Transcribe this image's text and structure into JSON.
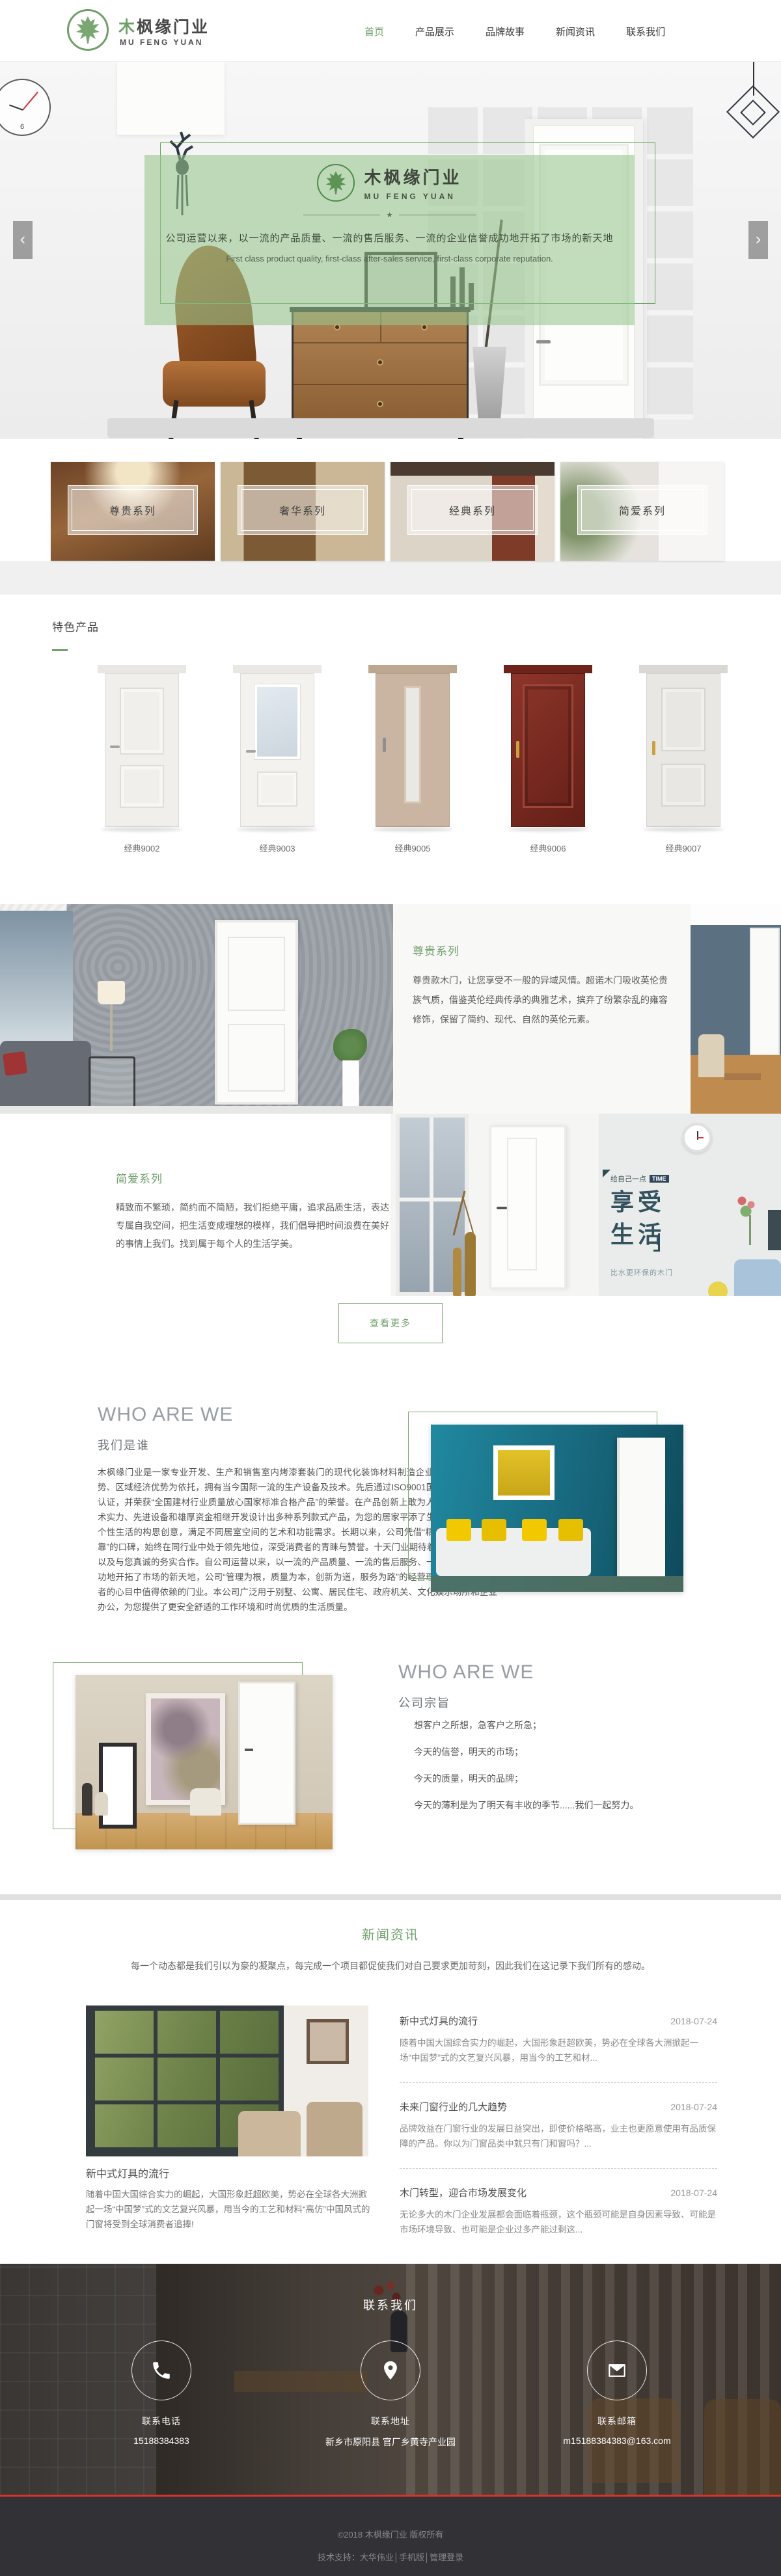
{
  "brand": {
    "name_first": "木",
    "name_rest": "枫缘门业",
    "name_en": "MU FENG YUAN"
  },
  "nav": {
    "items": [
      {
        "label": "首页",
        "active": true
      },
      {
        "label": "产品展示",
        "active": false
      },
      {
        "label": "品牌故事",
        "active": false
      },
      {
        "label": "新闻资讯",
        "active": false
      },
      {
        "label": "联系我们",
        "active": false
      }
    ]
  },
  "hero": {
    "logo_cn": "木枫缘门业",
    "logo_en": "MU FENG YUAN",
    "star": "★",
    "slogan_cn": "公司运营以来，以一流的产品质量、一流的售后服务、一流的企业信誉成功地开拓了市场的新天地",
    "slogan_en": "First class product quality, first-class after-sales service, first-class corporate reputation.",
    "prev": "‹",
    "next": "›"
  },
  "series_cards": [
    {
      "label": "尊贵系列"
    },
    {
      "label": "奢华系列"
    },
    {
      "label": "经典系列"
    },
    {
      "label": "简爱系列"
    }
  ],
  "featured": {
    "title": "特色产品",
    "products": [
      {
        "name": "经典9002"
      },
      {
        "name": "经典9003"
      },
      {
        "name": "经典9005"
      },
      {
        "name": "经典9006"
      },
      {
        "name": "经典9007"
      }
    ]
  },
  "zungui": {
    "title": "尊贵系列",
    "text": "尊贵款木门，让您享受不一般的异域风情。超诺木门吸收英伦贵族气质，借鉴英伦经典传承的典雅艺术，摈弃了纷繁杂乱的雍容修饰，保留了简约、现代、自然的英伦元素。"
  },
  "jianai": {
    "title": "简爱系列",
    "text": "精致而不繁琐，简约而不简陋，我们拒绝平庸，追求品质生活，表达专属自我空间，把生活变成理想的模样，我们倡导把时间浪费在美好的事情上我们。找到属于每个人的生活学美。",
    "promo_small": "给自己一点",
    "promo_tag": "TIME",
    "promo_big1": "享受",
    "promo_big2": "生活",
    "promo_sub": "比水更环保的木门"
  },
  "more_button": "查看更多",
  "about1": {
    "heading_en": "WHO ARE WE",
    "heading_cn": "我们是谁",
    "paragraph": "木枫缘门业是一家专业开发、生产和销售室内烤漆套装门的现代化装饰材料制造企业，公司以地域优势、区域经济优势为依托，拥有当今国际一流的生产设备及技术。先后通过ISO9001国际质量管理体系认证，并荣获“全国建材行业质量放心国家标准合格产品”的荣誉。在产品创新上敢为人先，凭借精尖技术实力、先进设备和雄厚资金相继开发设计出多种系列款式产品，为您的居家平添了生活的温馨，融入个性生活的构思创意，满足不同居室空间的艺术和功能需求。长期以来，公司凭借“精良品质、信誉可靠”的口碑，始终在同行业中处于领先地位，深受消费者的青睐与赞誉。十天门业期待着您睿智的眼光，以及与您真诚的务实合作。自公司运营以来，以一流的产品质量、一流的售后服务、一流的企业信誉成功地开拓了市场的新天地，公司“管理为根，质量为本，创新为道，服务为路”的经营理念，在广大消费者的心目中值得依赖的门业。本公司广泛用于别墅、公寓、居民住宅、政府机关、文化娱乐场所和企业办公，为您提供了更安全舒适的工作环境和时尚优质的生活质量。"
  },
  "about2": {
    "heading_en": "WHO ARE WE",
    "heading_cn": "公司宗旨",
    "lines": [
      "想客户之所想，急客户之所急；",
      "今天的信誉，明天的市场；",
      "今天的质量，明天的品牌；",
      "今天的薄利是为了明天有丰收的季节......我们一起努力。"
    ]
  },
  "news": {
    "title": "新闻资讯",
    "subtitle": "每一个动态都是我们引以为豪的凝聚点，每完成一个项目都促使我们对自己要求更加苛刻，因此我们在这记录下我们所有的感动。",
    "feature": {
      "title": "新中式灯具的流行",
      "text": "随着中国大国综合实力的崛起，大国形象赶超欧美，势必在全球各大洲掀起一场“中国梦”式的文艺复兴风暴，用当今的工艺和材料“高仿”中国风式的门窗将受到全球消费者追捧!"
    },
    "items": [
      {
        "title": "新中式灯具的流行",
        "date": "2018-07-24",
        "text": "随着中国大国综合实力的崛起，大国形象赶超欧美，势必在全球各大洲掀起一场“中国梦”式的文艺复兴风暴，用当今的工艺和材..."
      },
      {
        "title": "未来门窗行业的几大趋势",
        "date": "2018-07-24",
        "text": "品牌效益在门窗行业的发展日益突出，即使价格略高，业主也更愿意使用有品质保障的产品。你以为门窗品类中就只有门和窗吗？..."
      },
      {
        "title": "木门转型，迎合市场发展变化",
        "date": "2018-07-24",
        "text": "无论多大的木门企业发展都会面临着瓶颈，这个瓶颈可能是自身因素导致、可能是市场环境导致、也可能是企业过多产能过剩这..."
      }
    ]
  },
  "footer": {
    "title": "联系我们",
    "contacts": [
      {
        "label": "联系电话",
        "value": "15188384383"
      },
      {
        "label": "联系地址",
        "value": "新乡市原阳县 官厂乡黄寺产业园"
      },
      {
        "label": "联系邮箱",
        "value": "m15188384383@163.com"
      }
    ],
    "copyright": "©2018 木枫缘门业 版权所有",
    "support": "技术支持：大华伟业│手机版│管理登录"
  },
  "colors": {
    "accent": "#6fa06b",
    "hero_overlay": "rgba(151,198,141,0.58)",
    "red_line": "#e03126"
  }
}
